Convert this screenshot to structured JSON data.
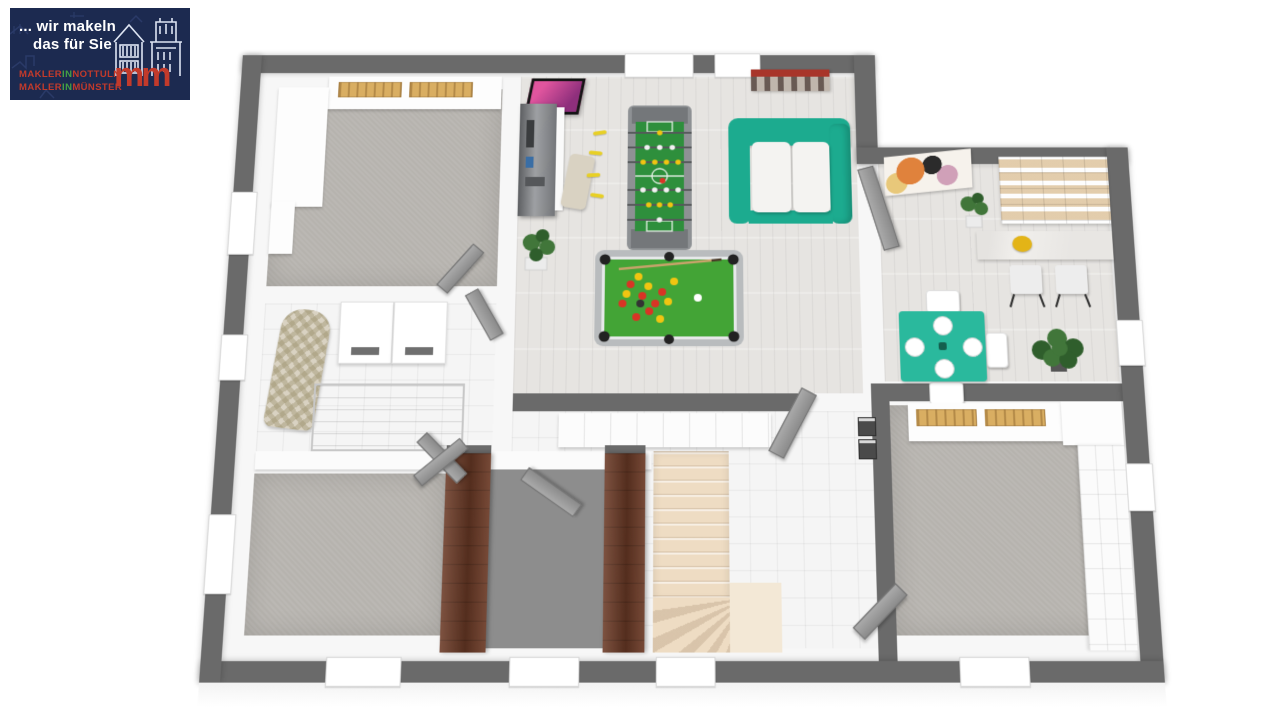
{
  "page": {
    "background": "#ffffff"
  },
  "logo": {
    "slogan_line1": "... wir makeln",
    "slogan_line2": "das für Sie",
    "monogram": "mm",
    "caption1": {
      "part1": "MAKLER",
      "part2": "IN",
      "part3": "NOTTULN"
    },
    "caption2": {
      "part1": "MAKLER",
      "part2": "IN",
      "part3": "MÜNSTER"
    },
    "colors": {
      "background": "#1c2a50",
      "text": "#ffffff",
      "red": "#c23a2b",
      "green": "#44a044",
      "sketch": "#dde4f2",
      "skyline": "#3c4f86"
    }
  },
  "scene": {
    "type": "3d-floorplan-render",
    "colors": {
      "wall_outer": "#6a6a6a",
      "wall_inner": "#f7f7f7",
      "floor_wood": "#e6e4e1",
      "floor_carpet": "#b6b3ae",
      "floor_tile": "#f5f5f5",
      "floor_entry": "#8d8d8d",
      "stairs": "#eedcc3",
      "stairs_landing": "#f3e8d6",
      "door_brown": "#6b3a26",
      "door_gray": "#9b9b9b",
      "sofa_teal": "#1cab8f",
      "dining_teal": "#2ab99d",
      "pool_frame": "#b9bcbe",
      "pool_felt": "#43a436",
      "foosball_frame": "#8e9194",
      "foosball_field": "#2e8f3c",
      "ball_red": "#d93425",
      "ball_yellow": "#f1c511",
      "ball_white": "#ffffff",
      "ball_black": "#222222",
      "cue": "#c9a36b",
      "plant": "#41763a",
      "plant_dark": "#2f5e2c",
      "books_tan": "#d9ae62",
      "art_pink": "#d8549e",
      "marble": "#f1efec",
      "bowl_yellow": "#e3b417",
      "cream": "#d9d2c2",
      "cushion_white": "#f4f3f1"
    }
  }
}
